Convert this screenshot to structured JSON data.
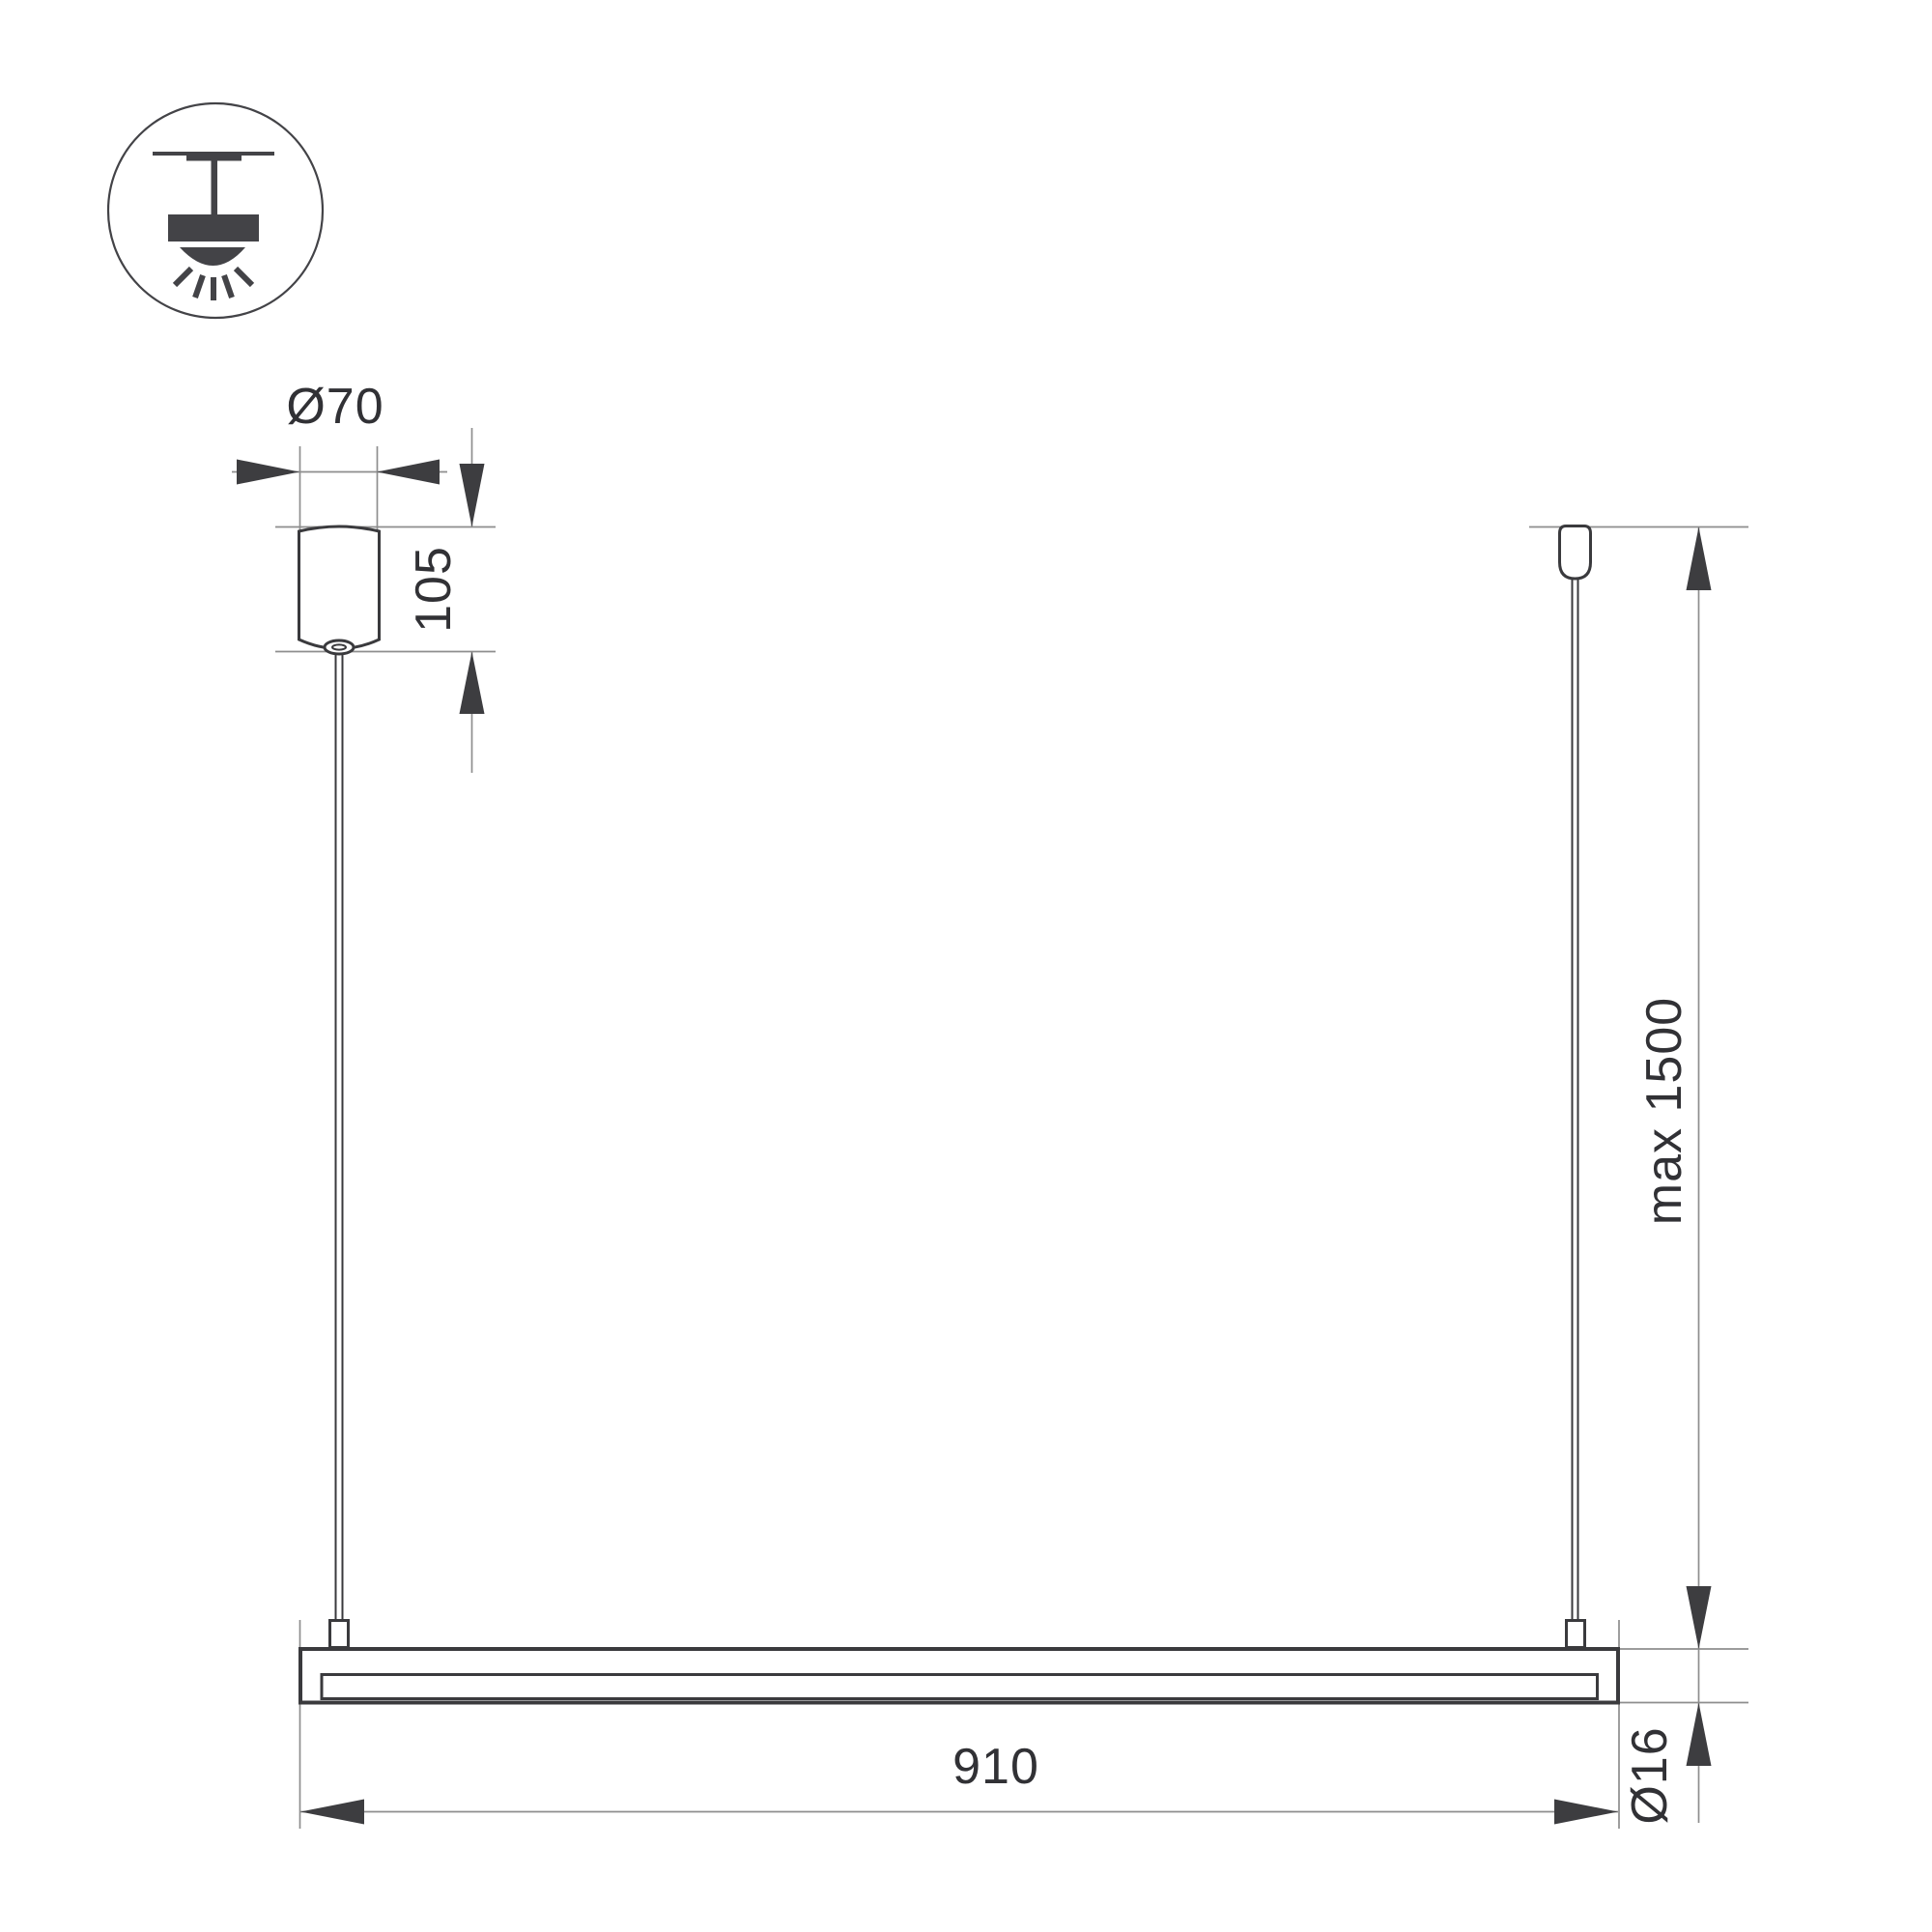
{
  "drawing": {
    "kind": "technical-dimension-drawing",
    "subject": "linear-pendant-light-fixture",
    "dims": {
      "canopy_diameter": {
        "label": "Ø70"
      },
      "canopy_height": {
        "label": "105"
      },
      "suspension_max": {
        "label": "max 1500"
      },
      "fixture_length": {
        "label": "910"
      },
      "tube_diameter": {
        "label": "Ø16"
      }
    },
    "icon": {
      "name": "ceiling-mounted-pendant-icon"
    }
  },
  "colors": {
    "outline": "#3a3a3d",
    "thin": "#8e8e8e",
    "arrow": "#3d3d40",
    "text": "#313135",
    "icon": "#434347",
    "bg": "#ffffff"
  }
}
